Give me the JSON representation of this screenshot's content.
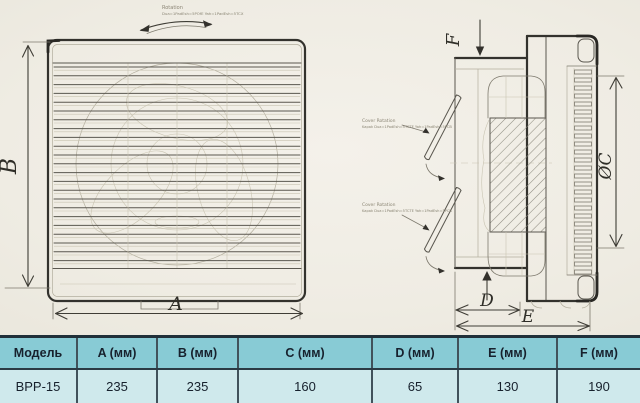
{
  "drawing": {
    "rotation_note": {
      "line1": "Rotation",
      "line2": "Dua=1PadEsh=5POfE Yah=1PadEsh=5TCX"
    },
    "cover_note_top": {
      "line1": "Cover Rotation",
      "line2": "Kapak Dua=1PadEsh=5TCTE Yah=1PadEsh=5PCB"
    },
    "cover_note_bottom": {
      "line1": "Cover Rotation",
      "line2": "Kapak Dua=1PadEsh=5TCTE Yah=1PadEsh=5PCB"
    },
    "labels": {
      "a": "A",
      "b": "B",
      "oc": "ØC",
      "d": "D",
      "e": "E",
      "f": "F"
    }
  },
  "table": {
    "headers": [
      "Модель",
      "A (мм)",
      "B (мм)",
      "C (мм)",
      "D (мм)",
      "E (мм)",
      "F (мм)"
    ],
    "row": [
      "BPP-15",
      "235",
      "235",
      "160",
      "65",
      "130",
      "190"
    ]
  },
  "colors": {
    "header_bg": "#88cbd5",
    "row_bg": "#cfe9ec",
    "table_border": "#203039",
    "text": "#17212d",
    "paper": "#efece3",
    "pencil": "#33322d"
  }
}
